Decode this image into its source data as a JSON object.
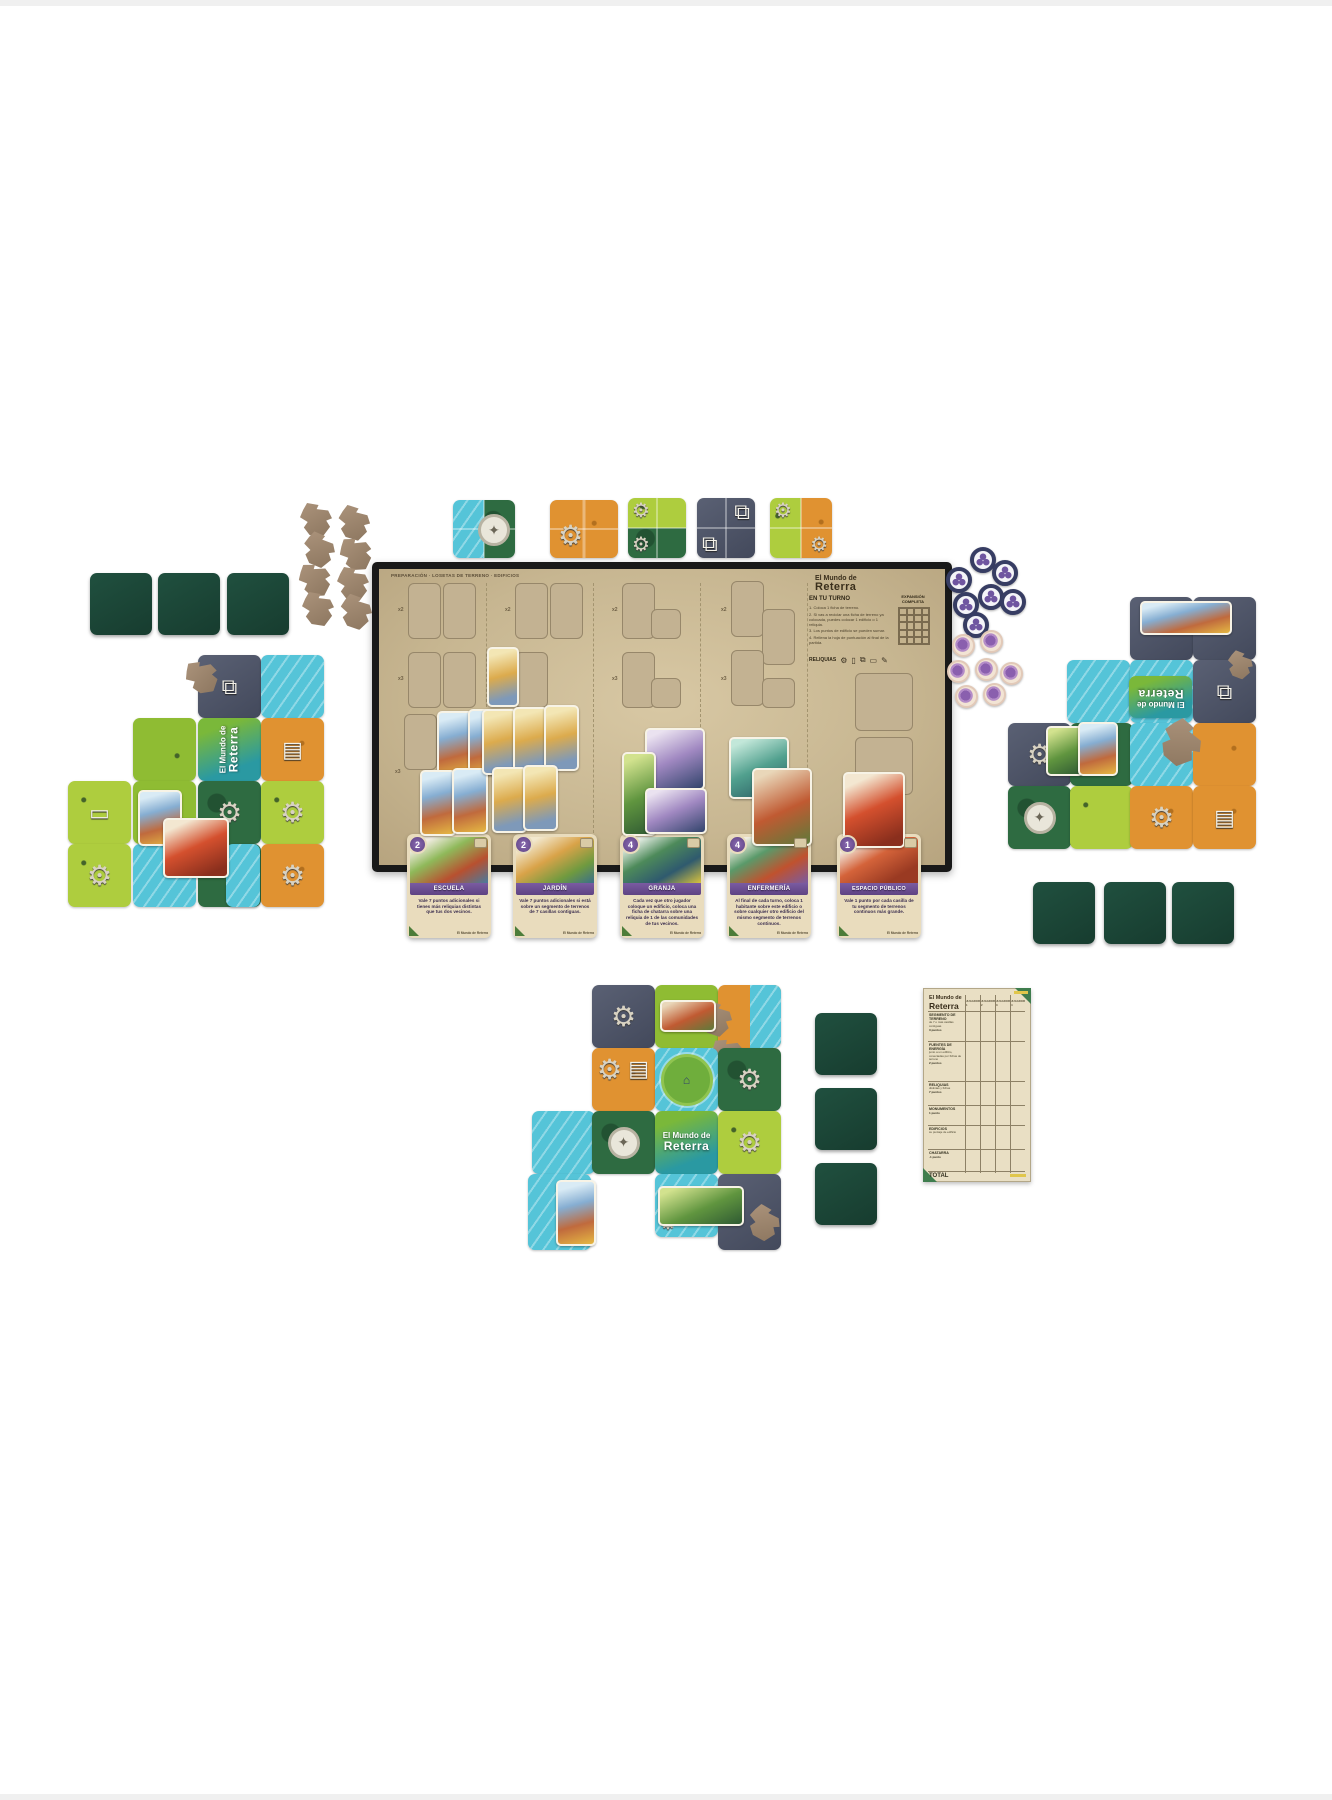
{
  "palette": {
    "board_beige": "#c7b691",
    "board_frame": "#191919",
    "water": "#55c4d8",
    "grass": "#aecd3e",
    "forest": "#2e6b41",
    "desert": "#e09231",
    "stone": "#4c5368",
    "facedown_green": "#1d4939",
    "card_purple": "#6b4d8e",
    "token_navy": "#373d63",
    "token_pink": "#e2c9b8",
    "ruin_brown": "#9b8573",
    "pad_green": "#3f7d4e",
    "pad_yellow": "#e0c64b"
  },
  "logo": {
    "line1": "El Mundo de",
    "line2": "Reterra"
  },
  "board": {
    "fine_print": "PREPARACIÓN · LOSETAS DE TERRENO · EDIFICIOS",
    "turn_header": "EN TU TURNO",
    "turn_steps": [
      "1.  Coloca 1 ficha de terreno.",
      "2.  Si vas a reciclar una ficha de terreno ya colocada, puedes colocar 1 edificio o 1 reliquia.",
      "3.  Los puntos de edificio se pueden sumar.",
      "4.  Rellena la hoja de puntuación al final de la partida."
    ],
    "expansion_label_1": "EXPANSIÓN",
    "expansion_label_2": "COMPLETA",
    "reliquias_label": "RELIQUIAS",
    "section_labels": {
      "top": "x2",
      "mid": "x3",
      "bottom": "x3"
    }
  },
  "icons": {
    "gear": "⚙",
    "books": "⧉",
    "star": "✦",
    "phone": "▯",
    "scroll": "▤",
    "pencil": "✎",
    "device": "▭",
    "figure": "⌂"
  },
  "card_footer_logo": "El Mundo de Reterra",
  "cards": [
    {
      "number": "2",
      "title": "ESCUELA",
      "body": "Vale 7 puntos adicionales si tienes más reliquias distintas que tus dos vecinos."
    },
    {
      "number": "2",
      "title": "JARDÍN",
      "body": "Vale 7 puntos adicionales si está sobre un segmento de terrenos de 7 casillas contiguas."
    },
    {
      "number": "4",
      "title": "GRANJA",
      "body": "Cada vez que otro jugador coloque un edificio, coloca una ficha de chatarra sobre una reliquia de 1 de las comunidades de tus vecinos."
    },
    {
      "number": "4",
      "title": "ENFERMERÍA",
      "body": "Al final de cada turno, coloca 1 habitante sobre este edificio o sobre cualquier otro edificio del mismo segmento de terrenos continuos."
    },
    {
      "number": "1",
      "title": "ESPACIO PÚBLICO",
      "body": "Vale 1 punto por cada casilla de tu segmento de terrenos continuos más grande."
    }
  ],
  "scorepad": {
    "columns": [
      "JUGADOR 1",
      "JUGADOR 2",
      "JUGADOR 3",
      "JUGADOR 4"
    ],
    "rows": [
      {
        "label": "SEGMENTO DE TERRENO",
        "sub": "de 7 o más casillas contiguas",
        "points": "3 puntos"
      },
      {
        "label": "FUENTES DE ENERGÍA",
        "sub": "junto a un edificio, conectadas por fichas de terreno",
        "points": "2 puntos"
      },
      {
        "label": "RELIQUIAS",
        "sub": "distintas y fichas",
        "points": "7 puntos"
      },
      {
        "label": "MONUMENTOS",
        "points": "1 punto"
      },
      {
        "label": "EDIFICIOS",
        "sub": "su puntaje de edificio",
        "points": ""
      },
      {
        "label": "CHATARRA",
        "points": "-1 punto"
      },
      {
        "label": "TOTAL"
      }
    ]
  }
}
